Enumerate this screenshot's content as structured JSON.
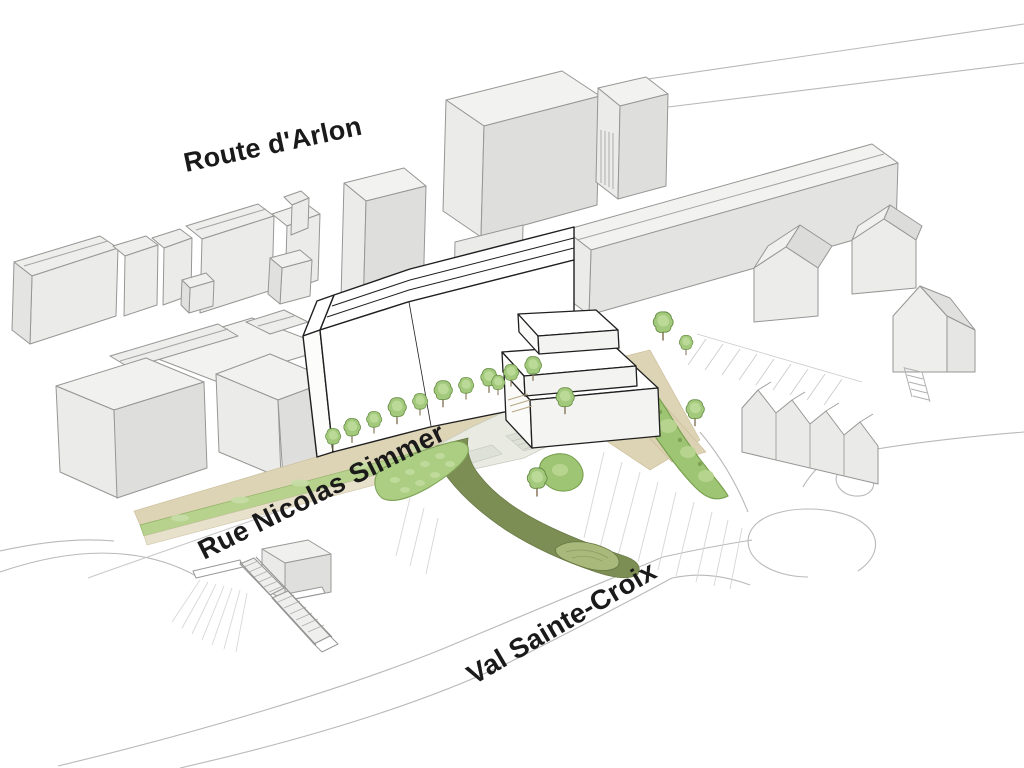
{
  "page": {
    "type": "architectural axonometric site plan illustration",
    "background": "#ffffff"
  },
  "labels": {
    "route_arlon": "Route d'Arlon",
    "rue_nicolas_simmer": "Rue Nicolas Simmer",
    "val_sainte_croix": "Val Sainte-Croix"
  },
  "palette": {
    "context_building_top": "#f2f2f1",
    "context_building_front": "#ebebea",
    "context_building_side": "#dededd",
    "context_outline": "#969695",
    "proposed_fill": "#ffffff",
    "proposed_outline": "#1f1f1f",
    "tree_green": "#a3ca7c",
    "tree_highlight": "#c3dda0",
    "tree_outline": "#638a40",
    "hedge_green": "#9ec573",
    "grass_green": "#b6d28d",
    "paving_beige": "#ddd3b5",
    "sidewalk_beige": "#e7e0ca",
    "plaza_gray_green": "#e9ebe2",
    "path_olive": "#7d8e55",
    "lawn_olive_light": "#a9b97c",
    "road_line": "#b9b9b9",
    "hatch_line": "#d6d6d6",
    "label_color": "#1a1a1a"
  }
}
